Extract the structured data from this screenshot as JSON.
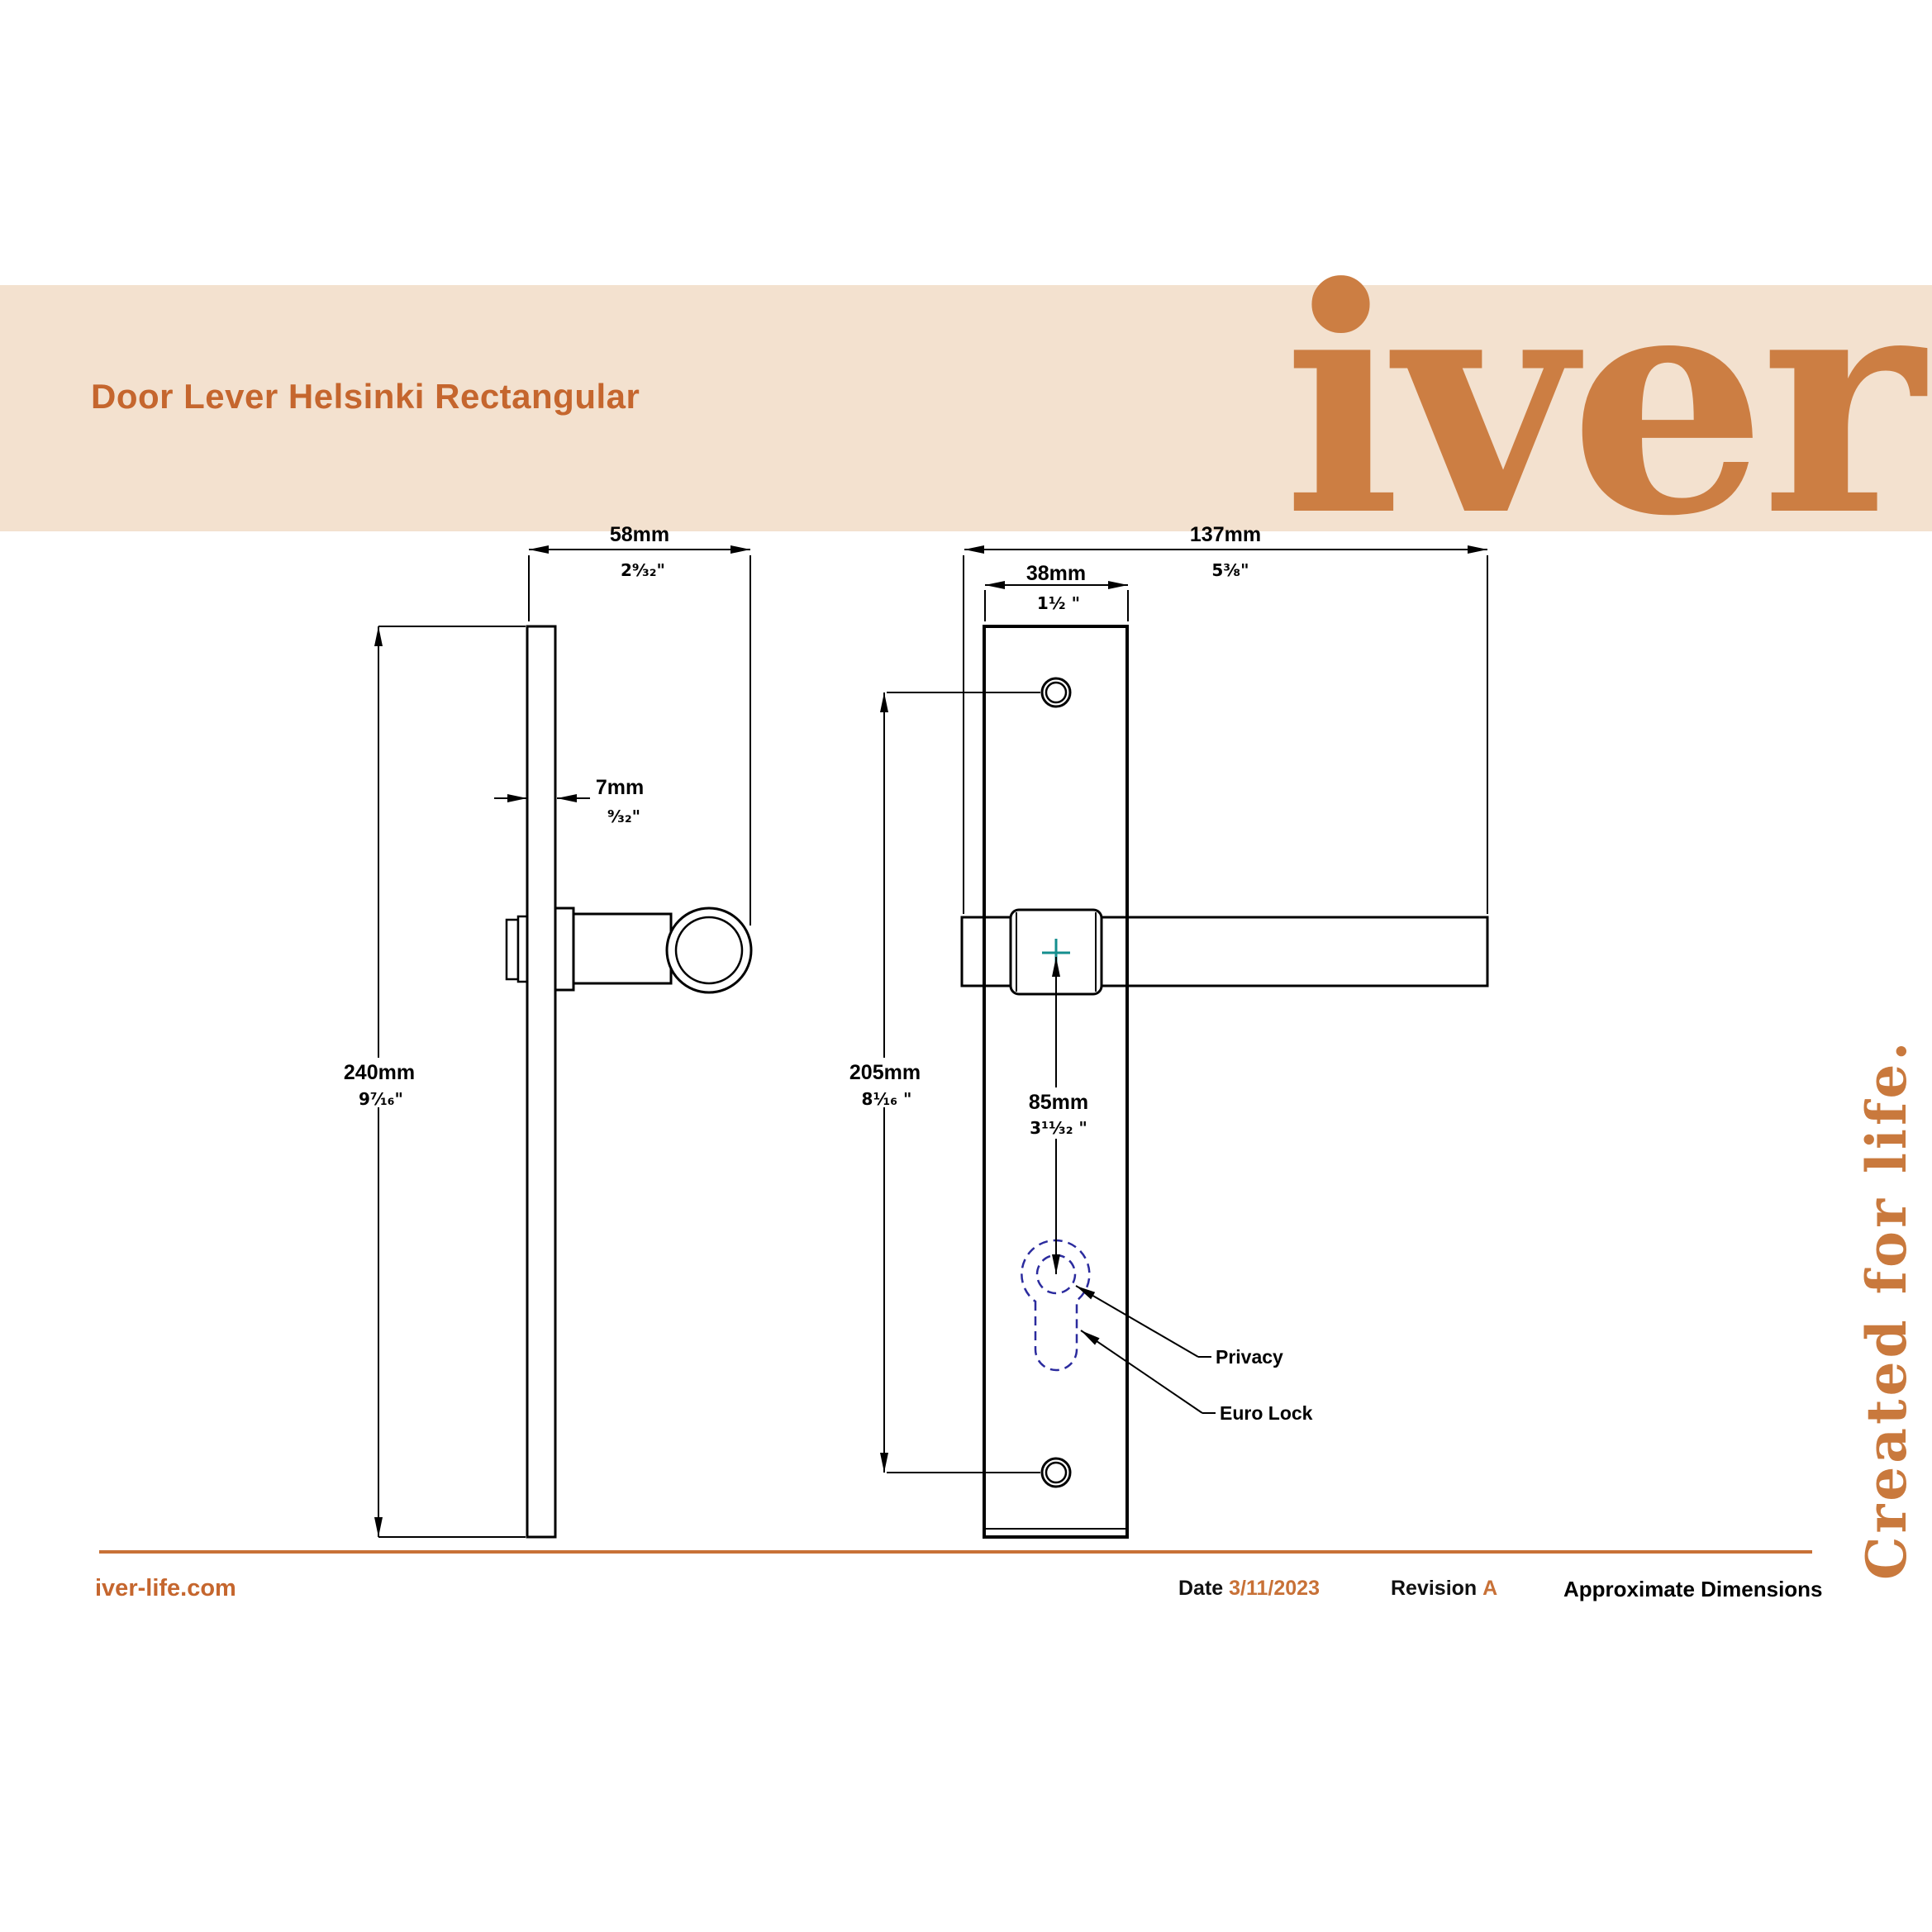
{
  "header": {
    "product_title": "Door Lever Helsinki Rectangular",
    "brand_logo": "iver"
  },
  "side_view": {
    "projection_width": {
      "mm": "58mm",
      "inch": "2⁹⁄₃₂\""
    },
    "plate_thickness": {
      "mm": "7mm",
      "inch": "⁹⁄₃₂\""
    },
    "plate_height": {
      "mm": "240mm",
      "inch": "9⁷⁄₁₆\""
    }
  },
  "front_view": {
    "lever_length": {
      "mm": "137mm",
      "inch": "5³⁄₈\""
    },
    "plate_width": {
      "mm": "38mm",
      "inch": "1¹⁄₂ \""
    },
    "fixing_centres": {
      "mm": "205mm",
      "inch": "8¹⁄₁₆ \""
    },
    "lock_centres": {
      "mm": "85mm",
      "inch": "3¹¹⁄₃₂ \""
    },
    "callouts": {
      "privacy": "Privacy",
      "euro_lock": "Euro Lock"
    }
  },
  "tagline": "Created for life.",
  "footer": {
    "website": "iver-life.com",
    "date_label": "Date",
    "date_value": "3/11/2023",
    "revision_label": "Revision",
    "revision_value": "A",
    "note": "Approximate Dimensions"
  },
  "colors": {
    "banner_bg": "#F3E1CF",
    "accent_orange": "#C5662E",
    "logo_orange": "#CC7E43",
    "rule_orange": "#C87137",
    "euro_dash_blue": "#2B2B9E",
    "centre_mark_teal": "#148E8E"
  }
}
